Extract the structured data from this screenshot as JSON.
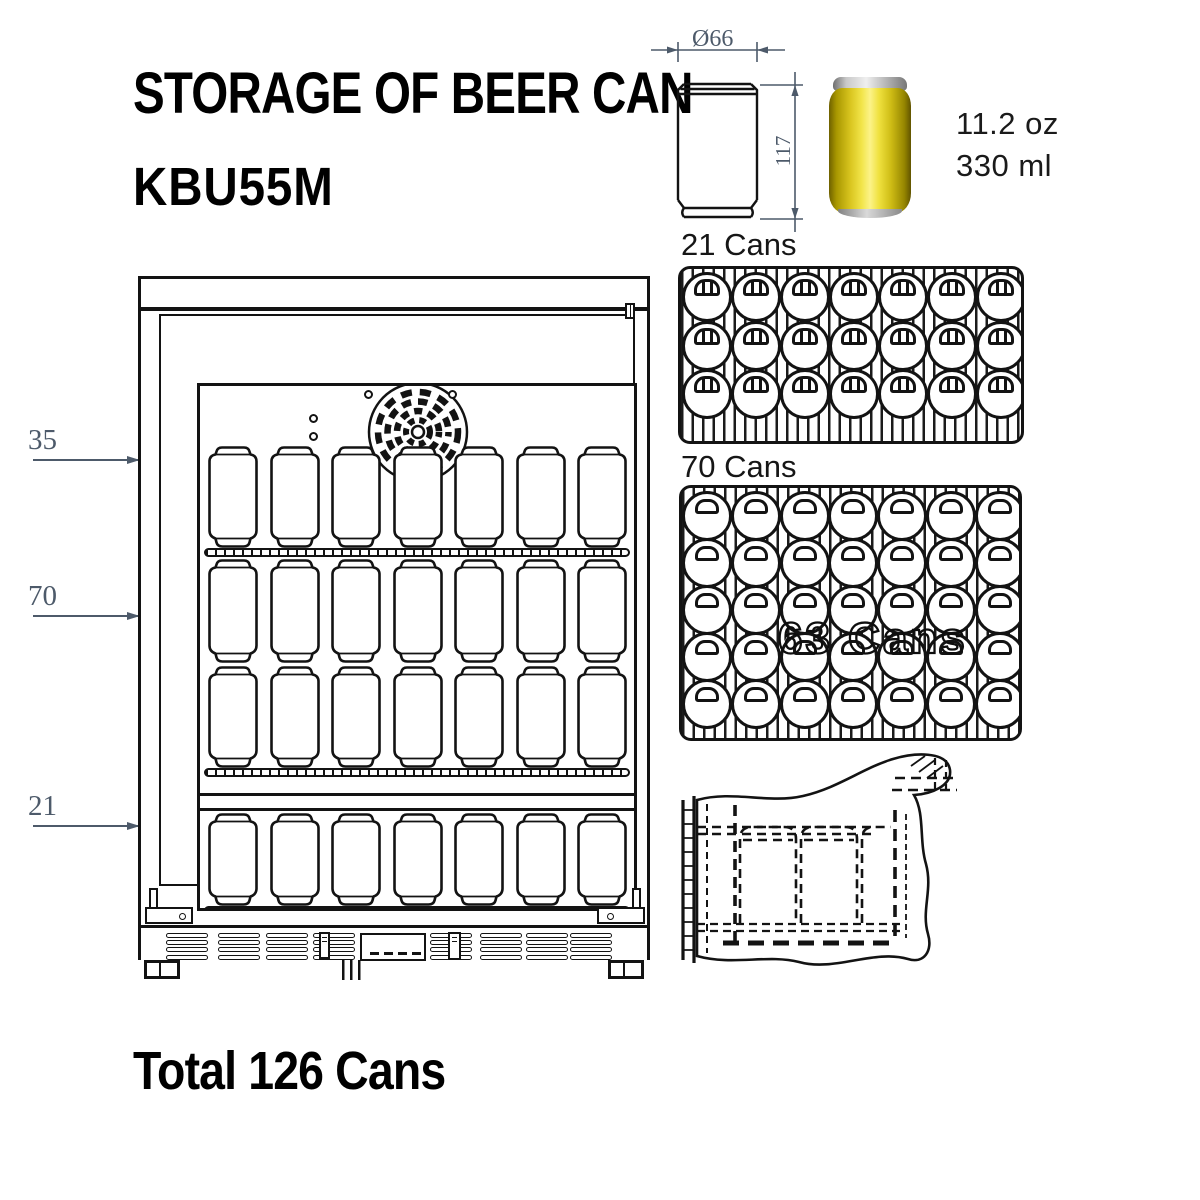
{
  "title": "STORAGE OF BEER CAN",
  "model": "KBU55M",
  "total": "Total 126 Cans",
  "colors": {
    "ink": "#131313",
    "dimension": "#4d5a6a",
    "can_body": "#f2e54a"
  },
  "can_spec": {
    "diameter": "Ø66",
    "height": "117",
    "volume_oz": "11.2 oz",
    "volume_ml": "330 ml"
  },
  "fridge": {
    "sections": [
      {
        "count": "35"
      },
      {
        "count": "70"
      },
      {
        "count": "21"
      }
    ],
    "can_rows": [
      7,
      7,
      7,
      7
    ]
  },
  "trays": [
    {
      "label": "21 Cans",
      "rows": 3,
      "cols": 7,
      "style": "striped"
    },
    {
      "label": "70 Cans",
      "rows": 5,
      "cols": 7,
      "style": "plain",
      "ghost": "63 Cans"
    }
  ]
}
